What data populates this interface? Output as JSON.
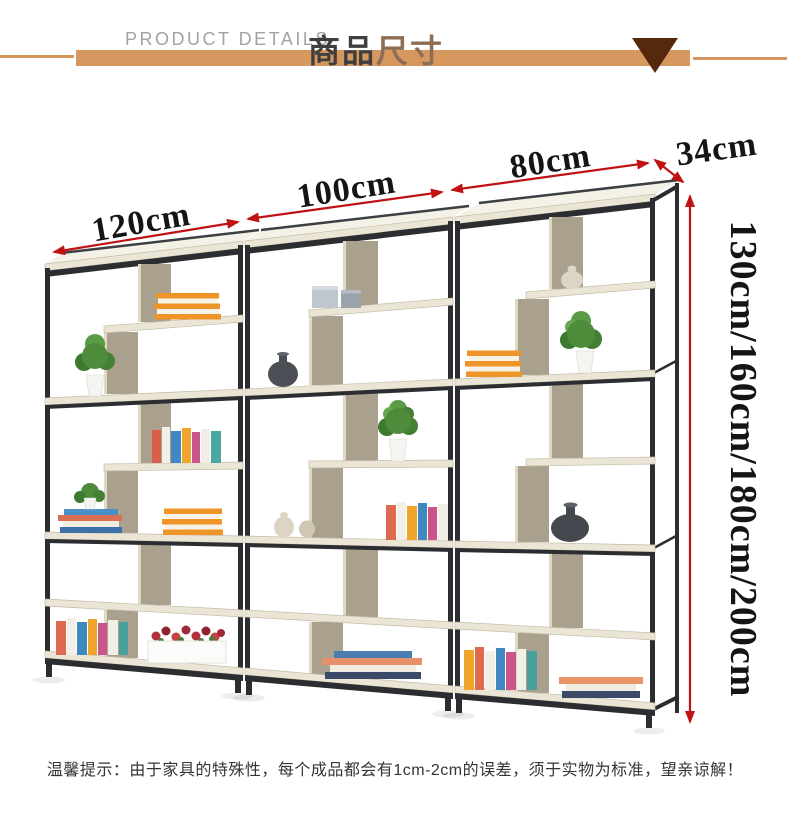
{
  "header": {
    "eyebrow": "PRODUCT DETAILS",
    "title_part_1": "商品",
    "title_part_2": "尺寸"
  },
  "dimensions": {
    "widths": [
      "120cm",
      "100cm",
      "80cm"
    ],
    "depth": "34cm",
    "height_options": "130cm/160cm/180cm/200cm"
  },
  "note": "温馨提示：由于家具的特殊性，每个成品都会有1cm-2cm的误差，须于实物为标准，望亲谅解！",
  "colors": {
    "banner": "#d6985f",
    "triangle": "#552a0c",
    "dimension_arrow": "#c01212",
    "dimension_text": "#151515",
    "shelf_frame": "#2b2d31",
    "shelf_board": "#eae5d4"
  }
}
